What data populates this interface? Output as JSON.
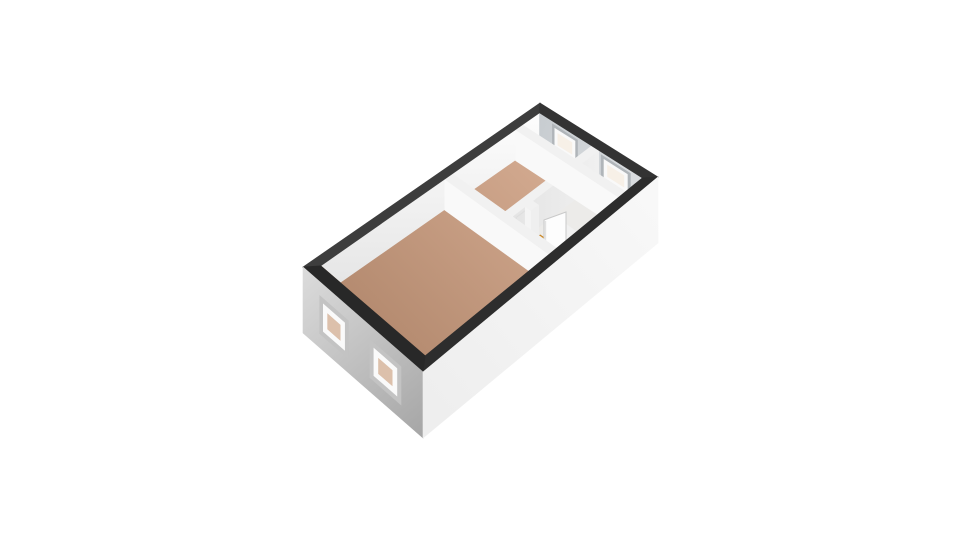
{
  "page": {
    "title": "3D floor plan view",
    "background": "#ffffff"
  },
  "floorplan": {
    "projection": {
      "corners": {
        "S": [
          423,
          372
        ],
        "E": [
          658,
          177
        ],
        "N": [
          540,
          103
        ],
        "W": [
          303,
          267
        ]
      },
      "floor_depth": 31,
      "exterior_depth": 66
    },
    "thickness": {
      "end": 0.038,
      "side": 0.065
    },
    "colors": {
      "background": "#ffffff",
      "ring_nw": "#3d3d3d",
      "ring_ne": "#333333",
      "ring_se": "#2d2d2d",
      "ring_sw": "#282828",
      "floor_light": "#ecebe9",
      "wood_dark": "#b1876c",
      "wood_light": "#d2a98f",
      "nw_face_top": "#fdfdfd",
      "nw_face_bottom": "#e4e4e4",
      "ne_face_a": "#c7ccd0",
      "ne_face_b": "#d9dcdf",
      "interior_wall_face": "#f9f9f9",
      "interior_wall_face2": "#f4f4f4",
      "spine_face_a": "#e4e4e4",
      "spine_face_b": "#f0f0f0",
      "wall_top_light": "#f1f1f1",
      "end_cap": "#fbfbfb",
      "jamb": "#efefef",
      "threshold": "#e2a23a",
      "threshold_edge": "#c07f22",
      "door_leaf": "#fdfdfd",
      "door_edge": "#c9c9c9",
      "door_shade": "#e2e2e2",
      "handle": "#8e8e8e",
      "door_hint": "#dedede",
      "ext_sw_light": "#dcdcdc",
      "ext_sw_dark": "#a5a5a5",
      "ext_se_light": "#f8f8f8",
      "ext_se_dark": "#eeeeee",
      "window_reveal": "#c3c3c3",
      "window_frame": "#fafafa",
      "window_glass_warm": "#dcc0ab",
      "ne_window_reveal": "#b0b5b9",
      "ne_window_frame": "#f9f9f9",
      "ne_window_glass": "#f7f0e7",
      "ne_window_sill": "#f3f3f3"
    },
    "rooms": [
      {
        "name": "living-room",
        "floor": "wood",
        "a": [
          0.038,
          0.525
        ],
        "b": [
          0.065,
          0.935
        ]
      },
      {
        "name": "hallway",
        "floor": "wood",
        "a": [
          0.558,
          0.845
        ],
        "b": [
          0.478,
          0.935
        ]
      },
      {
        "name": "bathroom",
        "floor": "light",
        "a": [
          0.558,
          0.615
        ],
        "b": [
          0.065,
          0.42
        ]
      },
      {
        "name": "storage-room",
        "floor": "light",
        "a": [
          0.648,
          0.845
        ],
        "b": [
          0.065,
          0.42
        ]
      },
      {
        "name": "bedroom-nw",
        "floor": "light",
        "a": [
          0.878,
          0.962
        ],
        "b": [
          0.478,
          0.935
        ]
      },
      {
        "name": "bedroom-se",
        "floor": "light",
        "a": [
          0.878,
          0.962
        ],
        "b": [
          0.065,
          0.42
        ]
      }
    ],
    "interior_walls": [
      {
        "name": "wall-spine",
        "dir": "u",
        "b": [
          0.42,
          0.478
        ],
        "a": [
          0.558,
          0.962
        ],
        "closed_door_a": [
          0.575,
          0.635
        ],
        "handle_line": [
          [
            512,
            231
          ],
          [
            518,
            234
          ]
        ]
      },
      {
        "name": "wall-ne-divider",
        "dir": "v",
        "a": [
          0.845,
          0.878
        ],
        "b": [
          0.065,
          0.935
        ]
      },
      {
        "name": "wall-bathroom",
        "dir": "v",
        "a": [
          0.615,
          0.648
        ],
        "b": [
          0.065,
          0.42
        ],
        "doorway_b": [
          0.17,
          0.37
        ]
      },
      {
        "name": "wall-main-divider",
        "dir": "v",
        "a": [
          0.525,
          0.558
        ],
        "b": [
          0.065,
          0.935
        ]
      }
    ],
    "door": {
      "name": "open-door",
      "threshold": {
        "a": [
          0.615,
          0.655
        ],
        "b": [
          0.17,
          0.37
        ]
      },
      "leaf_quad": [
        [
          544,
          220
        ],
        [
          566,
          212
        ],
        [
          566,
          252
        ],
        [
          544,
          264
        ]
      ],
      "leaf_handle": [
        558,
        250
      ]
    },
    "windows": {
      "sw_exterior": [
        {
          "name": "window-sw-1",
          "b": [
            0.6,
            0.85
          ],
          "h": [
            14,
            52
          ]
        },
        {
          "name": "window-sw-2",
          "b": [
            0.17,
            0.42
          ],
          "h": [
            14,
            52
          ]
        }
      ],
      "ne_interior": [
        {
          "name": "window-ne-a",
          "b": [
            0.6,
            0.82
          ],
          "h": [
            3,
            27
          ]
        },
        {
          "name": "window-ne-b",
          "b": [
            0.16,
            0.4
          ],
          "h": [
            3,
            27
          ]
        }
      ]
    }
  }
}
